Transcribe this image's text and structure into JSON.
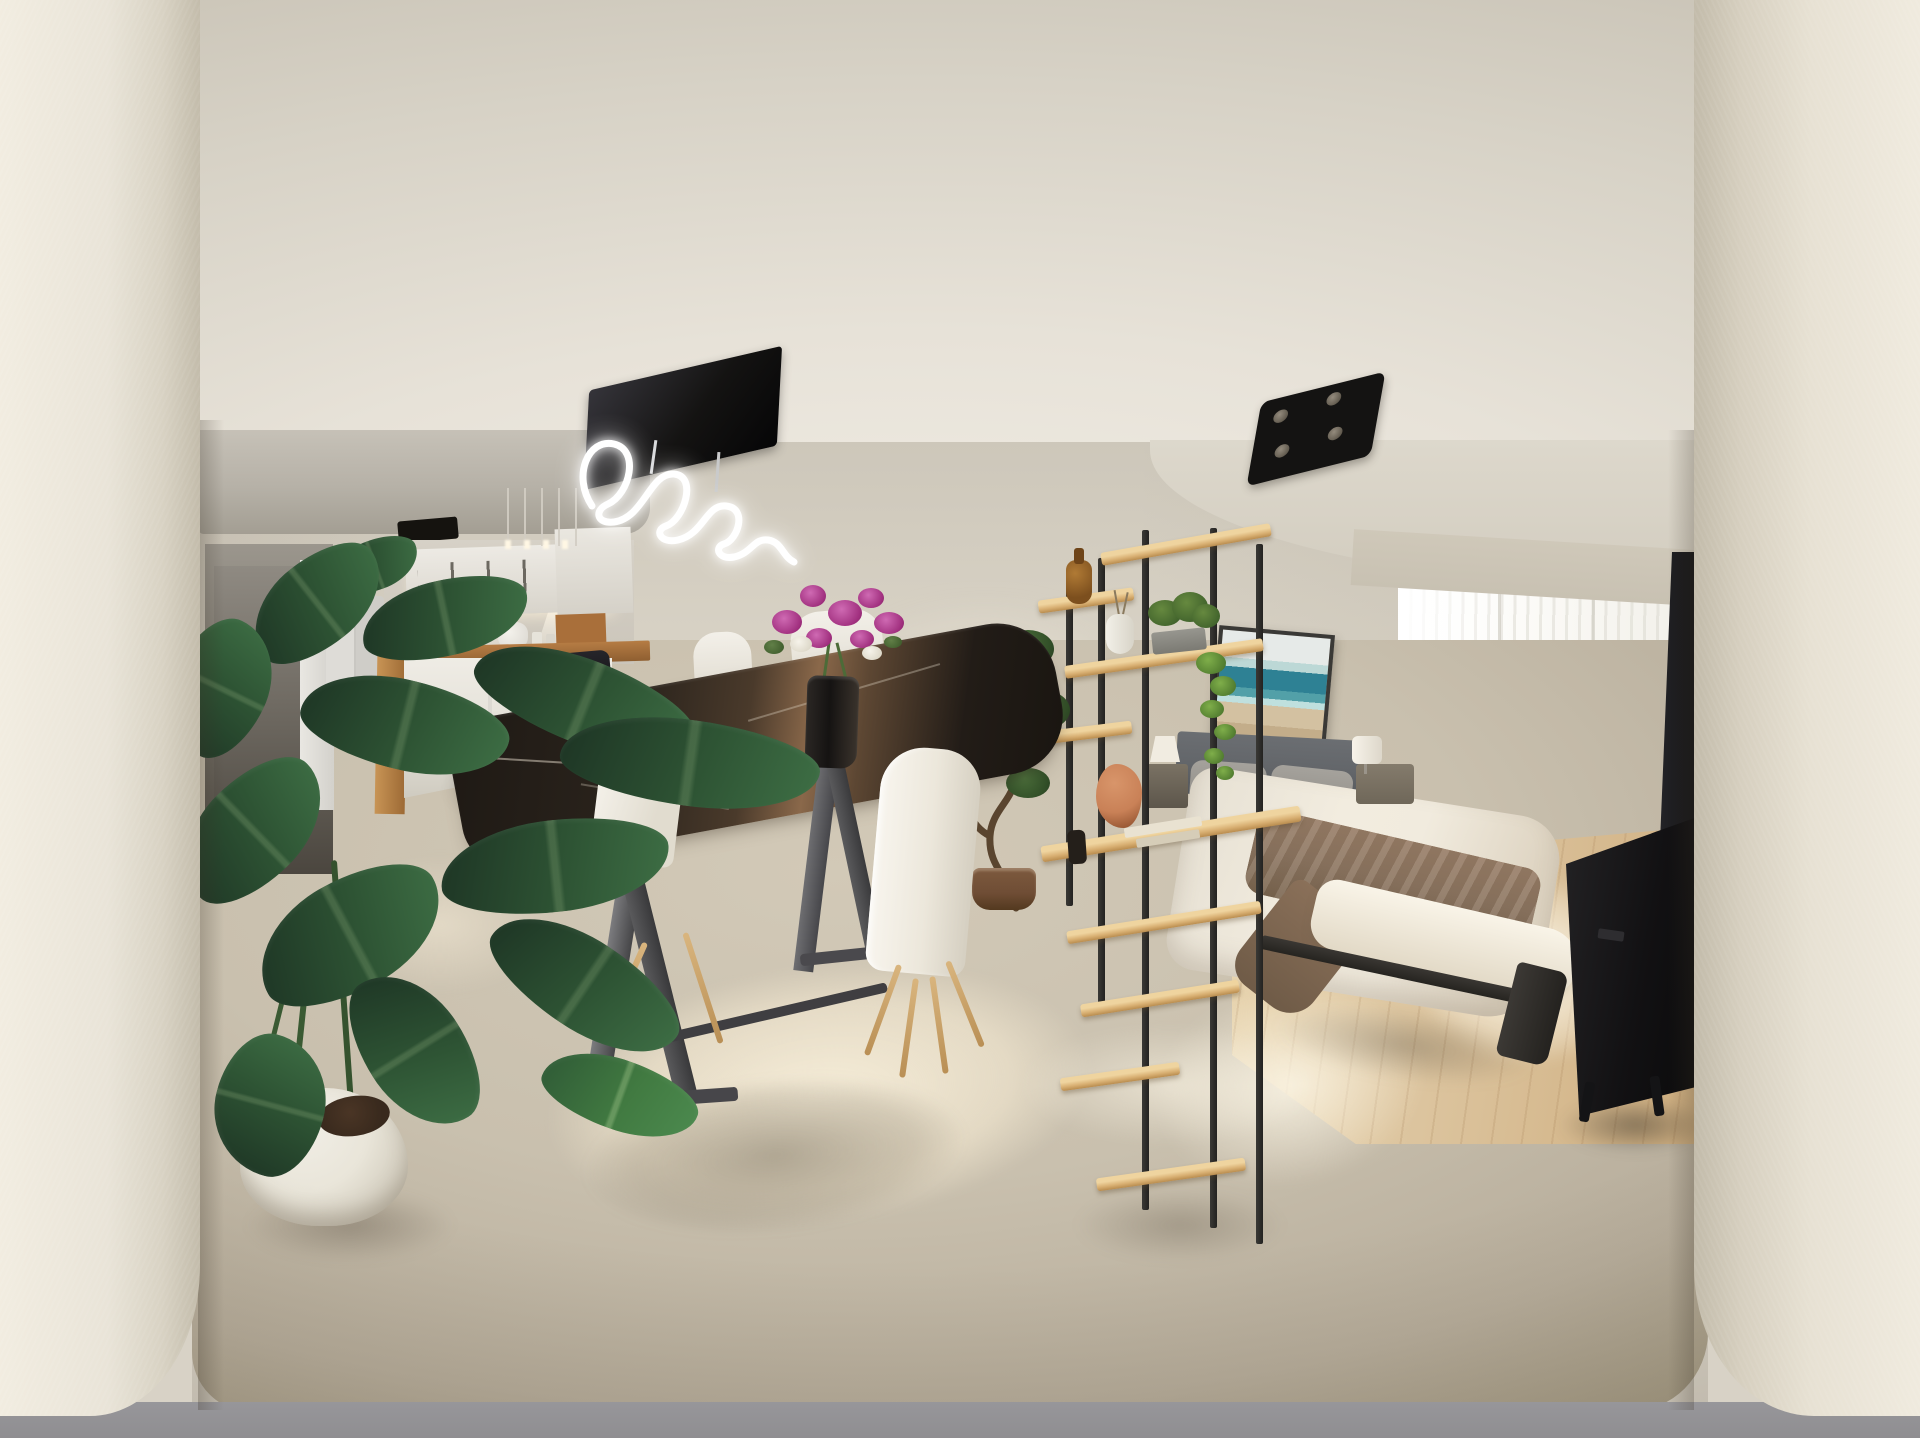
{
  "image": {
    "kind": "360-degree interior panorama photograph",
    "aria": "360-degree panorama of a furnished studio apartment with kitchenette, dining table, shelving room divider, double bed, bright balcony window and TV sideboard between two foreground wall pillars"
  },
  "palette": {
    "pillar": "#e9e4d8",
    "ceiling_hi": "#f3efe7",
    "ceiling_lo": "#d7d2c6",
    "wall": "#d7d1c4",
    "soffit": "#b6b1a7",
    "corridor_dark": "#4b463f",
    "cabinet_hi": "#edeae4",
    "handle": "#57534b",
    "glow": "#fff7e4",
    "counter_wood": "#b57c44",
    "island": "#efece5",
    "stool_seat": "#1a191d",
    "marble_dark": "#221c17",
    "marble_sun": "#8a684a",
    "leg_metal": "#454547",
    "chair_white": "#f3f0e9",
    "chair_leg": "#c8a067",
    "carpet": "#c9c0ae",
    "sun_patch": "#f9f0dc",
    "wood_floor": "#dcc49e",
    "window": "#fcfbf8",
    "rail": "#f4f3ee",
    "pelmet": "#c8c1b2",
    "art_sea": "#2e8194",
    "art_sand": "#d3c1a1",
    "headboard": "#63666a",
    "pillow_light": "#dbd6cb",
    "duvet": "#f1ebde",
    "throw": "#8c7560",
    "nightstand": "#6f6759",
    "lampshade": "#f1ece1",
    "tv_black": "#101012",
    "shelf_wood": "#d8af72",
    "shelf_wood_hi": "#efd49f",
    "ivy": "#7fae4a",
    "coral": "#c98157",
    "bonsai_pot": "#6f4d35",
    "leaf_a": "#1d3424",
    "leaf_b": "#2e5434",
    "leaf_c": "#3e6f45",
    "pot_white": "#f1eee6",
    "soil": "#38291d",
    "neon": "#ffffff",
    "fixture_black": "#141312",
    "spot_dot": "#948b7d",
    "band": "#8f8e91"
  },
  "scene": {
    "pillars": {
      "label": "foreground wall pillars framing the panorama"
    },
    "ceiling": {
      "label": "cream ceiling",
      "neon_light": "black panel pendant with white neon scribble tube",
      "spot_light": "black square four-spot ceiling lamp",
      "vent": "black ceiling vent",
      "pendants": "five thin pendant light rods over breakfast bar"
    },
    "kitchen": {
      "label": "kitchenette",
      "items": [
        "hallway doorway",
        "white door",
        "refrigerator",
        "white upper cabinets with dark handles",
        "under-cabinet light cones",
        "sink faucet",
        "white kettle",
        "wood counter strip",
        "wood-sided island breakfast bar",
        "two black-seat bar stools"
      ]
    },
    "dining": {
      "label": "dining area",
      "items": [
        "black marble dining table with sunlit veining",
        "dark metal trapezoid legs",
        "white shell chairs with wood legs",
        "glass vase with magenta and white flowers"
      ]
    },
    "divider": {
      "label": "open shelving room divider",
      "items": [
        "amber glass bottle",
        "white vase with twigs",
        "potted plant in gray planter",
        "trailing ivy",
        "coral decor piece",
        "stacked books and trays",
        "dark bottle"
      ]
    },
    "bedroom": {
      "label": "sleeping area",
      "items": [
        "framed beach artwork",
        "gray upholstered headboard",
        "pillows in gray and cream",
        "white duvet with taupe throw blanket",
        "dark bed frame",
        "two nightstands with white lamps"
      ]
    },
    "window": {
      "label": "balcony window wall",
      "items": [
        "sheer white curtains",
        "glass door mullions",
        "white balcony railing",
        "sunlit light oak floor"
      ]
    },
    "media": {
      "label": "TV corner",
      "items": [
        "edge-on black TV panel",
        "black sideboard console on angled legs"
      ]
    },
    "plants": {
      "label": "greenery",
      "items": [
        "large banana plant in round white pot",
        "S-curved bonsai tree in brown pot"
      ]
    },
    "floor": {
      "label": "floors",
      "items": [
        "beige carpet with bright sun patches",
        "light oak flooring by the window",
        "gray base band at image bottom"
      ]
    }
  }
}
